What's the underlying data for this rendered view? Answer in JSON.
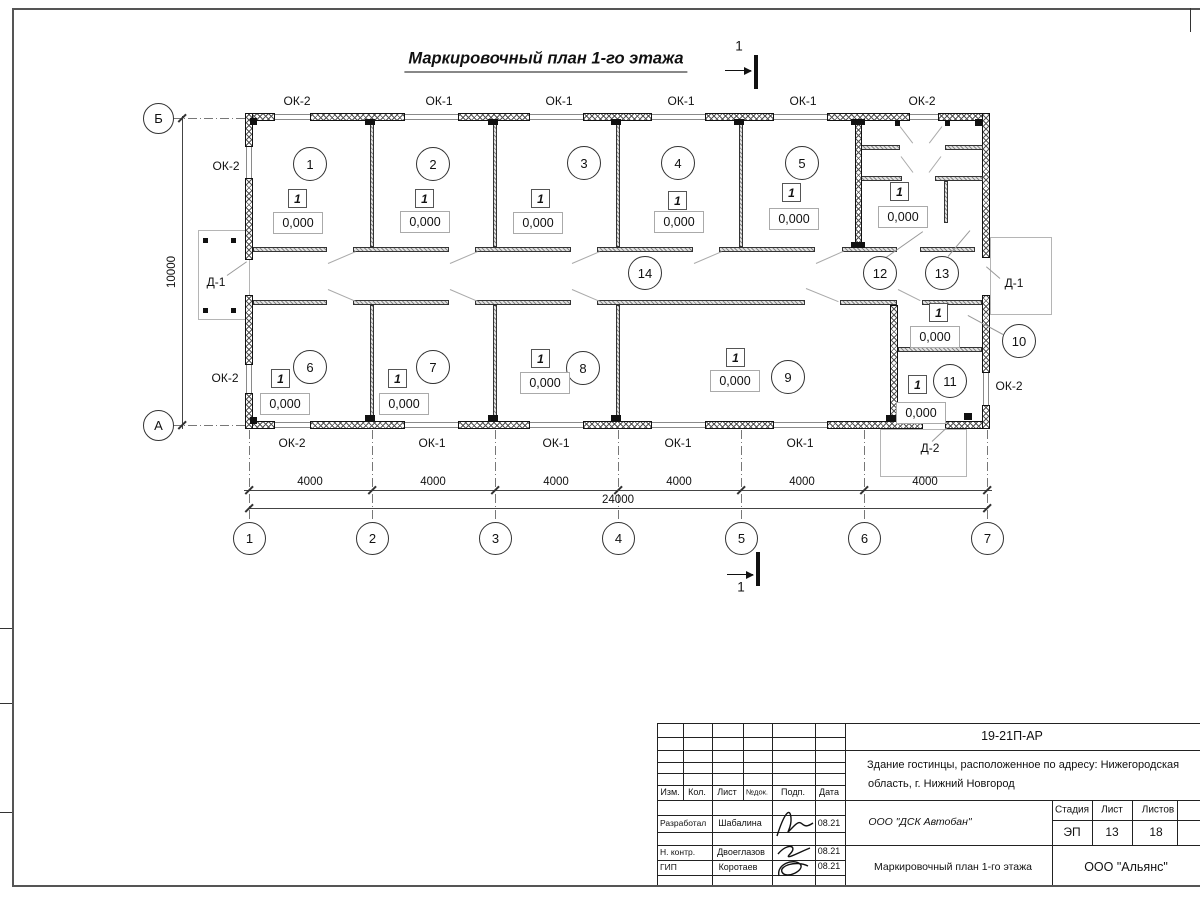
{
  "title": "Маркировочный план 1-го этажа",
  "section_mark_label": "1",
  "plan": {
    "walls_ext_h": [
      [
        245,
        113,
        30
      ],
      [
        310,
        113,
        95
      ],
      [
        458,
        113,
        72
      ],
      [
        583,
        113,
        69
      ],
      [
        705,
        113,
        69
      ],
      [
        827,
        113,
        83
      ],
      [
        938,
        113,
        52
      ],
      [
        245,
        421,
        30
      ],
      [
        310,
        421,
        95
      ],
      [
        458,
        421,
        72
      ],
      [
        583,
        421,
        69
      ],
      [
        705,
        421,
        69
      ],
      [
        827,
        421,
        96
      ],
      [
        945,
        421,
        45
      ]
    ],
    "walls_ext_v": [
      [
        245,
        113,
        34
      ],
      [
        245,
        178,
        82
      ],
      [
        245,
        295,
        70
      ],
      [
        245,
        393,
        36
      ],
      [
        982,
        113,
        145
      ],
      [
        982,
        295,
        78
      ],
      [
        982,
        405,
        24
      ]
    ],
    "walls_int_h": [
      [
        253,
        247,
        74
      ],
      [
        353,
        247,
        96
      ],
      [
        475,
        247,
        96
      ],
      [
        597,
        247,
        96
      ],
      [
        719,
        247,
        96
      ],
      [
        842,
        247,
        55
      ],
      [
        920,
        247,
        55
      ],
      [
        253,
        300,
        74
      ],
      [
        353,
        300,
        96
      ],
      [
        475,
        300,
        96
      ],
      [
        597,
        300,
        208
      ],
      [
        840,
        300,
        57
      ],
      [
        922,
        300,
        60
      ],
      [
        898,
        347,
        84
      ],
      [
        860,
        145,
        40
      ],
      [
        945,
        145,
        38
      ],
      [
        858,
        176,
        44
      ],
      [
        935,
        176,
        48
      ]
    ],
    "walls_int_v": [
      [
        370,
        121,
        126
      ],
      [
        493,
        121,
        126
      ],
      [
        616,
        121,
        126
      ],
      [
        739,
        121,
        126
      ],
      [
        370,
        305,
        116
      ],
      [
        493,
        305,
        116
      ],
      [
        616,
        305,
        116
      ],
      [
        944,
        181,
        42
      ]
    ],
    "walls_thick_v": [
      [
        855,
        121,
        7,
        127
      ],
      [
        890,
        305,
        8,
        116
      ]
    ],
    "caps": [
      [
        365,
        119,
        10,
        6
      ],
      [
        488,
        119,
        10,
        6
      ],
      [
        611,
        119,
        10,
        6
      ],
      [
        734,
        119,
        10,
        6
      ],
      [
        851,
        119,
        14,
        6
      ],
      [
        851,
        242,
        14,
        6
      ],
      [
        365,
        415,
        10,
        6
      ],
      [
        488,
        415,
        10,
        6
      ],
      [
        611,
        415,
        10,
        6
      ],
      [
        886,
        415,
        14,
        6
      ],
      [
        250,
        118,
        7,
        7
      ],
      [
        250,
        417,
        7,
        7
      ],
      [
        975,
        119,
        7,
        7
      ],
      [
        964,
        413,
        8,
        7
      ],
      [
        895,
        120,
        5,
        6
      ],
      [
        945,
        120,
        5,
        6
      ]
    ],
    "windows_h": [
      [
        275,
        114,
        35
      ],
      [
        405,
        114,
        53
      ],
      [
        530,
        114,
        53
      ],
      [
        652,
        114,
        53
      ],
      [
        774,
        114,
        53
      ],
      [
        910,
        114,
        28
      ],
      [
        275,
        422,
        35
      ],
      [
        405,
        422,
        53
      ],
      [
        530,
        422,
        53
      ],
      [
        652,
        422,
        53
      ],
      [
        774,
        422,
        53
      ]
    ],
    "windows_v": [
      [
        246,
        147,
        31
      ],
      [
        246,
        365,
        28
      ],
      [
        983,
        373,
        32
      ]
    ],
    "porches": [
      [
        198,
        230,
        52,
        90
      ],
      [
        990,
        237,
        62,
        78
      ],
      [
        880,
        429,
        87,
        48
      ]
    ],
    "posts": [
      [
        203,
        238
      ],
      [
        231,
        238
      ],
      [
        203,
        308
      ],
      [
        231,
        308
      ]
    ],
    "rooms": [
      {
        "num": "1",
        "x": 310,
        "y": 164
      },
      {
        "num": "2",
        "x": 433,
        "y": 164
      },
      {
        "num": "3",
        "x": 584,
        "y": 163
      },
      {
        "num": "4",
        "x": 678,
        "y": 163
      },
      {
        "num": "5",
        "x": 802,
        "y": 163
      },
      {
        "num": "6",
        "x": 310,
        "y": 367
      },
      {
        "num": "7",
        "x": 433,
        "y": 367
      },
      {
        "num": "8",
        "x": 583,
        "y": 368
      },
      {
        "num": "9",
        "x": 788,
        "y": 377
      },
      {
        "num": "10",
        "x": 1019,
        "y": 341
      },
      {
        "num": "11",
        "x": 950,
        "y": 381
      },
      {
        "num": "12",
        "x": 880,
        "y": 273
      },
      {
        "num": "13",
        "x": 942,
        "y": 273
      },
      {
        "num": "14",
        "x": 645,
        "y": 273
      }
    ],
    "floor_mark_text": "1",
    "floor_marks": [
      [
        297,
        198
      ],
      [
        424,
        198
      ],
      [
        540,
        198
      ],
      [
        677,
        200
      ],
      [
        791,
        192
      ],
      [
        899,
        191
      ],
      [
        280,
        378
      ],
      [
        397,
        378
      ],
      [
        540,
        358
      ],
      [
        735,
        357
      ],
      [
        938,
        312
      ],
      [
        917,
        384
      ]
    ],
    "elevation_text": "0,000",
    "elevations": [
      [
        297,
        222
      ],
      [
        424,
        221
      ],
      [
        537,
        222
      ],
      [
        678,
        221
      ],
      [
        793,
        218
      ],
      [
        902,
        216
      ],
      [
        284,
        403
      ],
      [
        403,
        403
      ],
      [
        544,
        382
      ],
      [
        734,
        380
      ],
      [
        934,
        336
      ],
      [
        920,
        412
      ]
    ],
    "window_labels": [
      {
        "t": "ОК-2",
        "x": 297,
        "y": 101
      },
      {
        "t": "ОК-1",
        "x": 439,
        "y": 101
      },
      {
        "t": "ОК-1",
        "x": 559,
        "y": 101
      },
      {
        "t": "ОК-1",
        "x": 681,
        "y": 101
      },
      {
        "t": "ОК-1",
        "x": 803,
        "y": 101
      },
      {
        "t": "ОК-2",
        "x": 922,
        "y": 101
      },
      {
        "t": "ОК-2",
        "x": 292,
        "y": 443
      },
      {
        "t": "ОК-1",
        "x": 432,
        "y": 443
      },
      {
        "t": "ОК-1",
        "x": 556,
        "y": 443
      },
      {
        "t": "ОК-1",
        "x": 678,
        "y": 443
      },
      {
        "t": "ОК-1",
        "x": 800,
        "y": 443
      },
      {
        "t": "ОК-2",
        "x": 226,
        "y": 166
      },
      {
        "t": "ОК-2",
        "x": 225,
        "y": 378
      },
      {
        "t": "ОК-2",
        "x": 1009,
        "y": 386
      }
    ],
    "door_labels": [
      {
        "t": "Д-1",
        "x": 216,
        "y": 282
      },
      {
        "t": "Д-1",
        "x": 1014,
        "y": 283
      },
      {
        "t": "Д-2",
        "x": 930,
        "y": 448
      }
    ],
    "swings": [
      [
        328,
        263,
        356,
        251
      ],
      [
        450,
        263,
        478,
        251
      ],
      [
        572,
        263,
        600,
        251
      ],
      [
        694,
        263,
        722,
        251
      ],
      [
        816,
        263,
        843,
        251
      ],
      [
        328,
        289,
        356,
        301
      ],
      [
        450,
        289,
        478,
        301
      ],
      [
        572,
        289,
        600,
        301
      ],
      [
        806,
        288,
        838,
        301
      ],
      [
        898,
        289,
        920,
        300
      ],
      [
        900,
        126,
        913,
        143
      ],
      [
        942,
        126,
        929,
        143
      ],
      [
        901,
        156,
        913,
        172
      ],
      [
        941,
        156,
        929,
        172
      ]
    ],
    "leaders": [
      [
        227,
        275,
        247,
        261
      ],
      [
        1000,
        278,
        986,
        266
      ],
      [
        932,
        441,
        947,
        427
      ],
      [
        1003,
        334,
        968,
        315
      ],
      [
        886,
        257,
        923,
        231
      ],
      [
        948,
        256,
        970,
        230
      ]
    ],
    "axes_v": [
      {
        "label": "1",
        "x": 249
      },
      {
        "label": "2",
        "x": 372
      },
      {
        "label": "3",
        "x": 495
      },
      {
        "label": "4",
        "x": 618
      },
      {
        "label": "5",
        "x": 741
      },
      {
        "label": "6",
        "x": 864
      },
      {
        "label": "7",
        "x": 987
      }
    ],
    "axes_h": [
      {
        "label": "Б",
        "y": 118
      },
      {
        "label": "А",
        "y": 425
      }
    ],
    "dim_span_text": "4000",
    "dim_spans_x": [
      310,
      433,
      556,
      679,
      802,
      925
    ],
    "dim_total_text": "24000",
    "dim_vertical_text": "10000"
  },
  "titleblock": {
    "doc_code": "19-21П-АР",
    "object_line1": "Здание гостинцы, расположенное по адресу: Нижегородская",
    "object_line2": "область, г. Нижний Новгород",
    "org_designer": "ООО \"ДСК Автобан\"",
    "sheet_title": "Маркировочный план 1-го этажа",
    "org_customer": "ООО \"Альянс\"",
    "headers": {
      "izm": "Изм.",
      "kol": "Кол.",
      "list": "Лист",
      "ndok": "№док.",
      "podp": "Подп.",
      "data": "Дата",
      "stage": "Стадия",
      "sheet": "Лист",
      "sheets": "Листов"
    },
    "stage_value": "ЭП",
    "sheet_value": "13",
    "sheets_value": "18",
    "rows": [
      {
        "role": "Разработал",
        "name": "Шабалина",
        "date": "08.21"
      },
      {
        "role": "Н. контр.",
        "name": "Двоеглазов",
        "date": "08.21"
      },
      {
        "role": "ГИП",
        "name": "Коротаев",
        "date": "08.21"
      }
    ]
  }
}
